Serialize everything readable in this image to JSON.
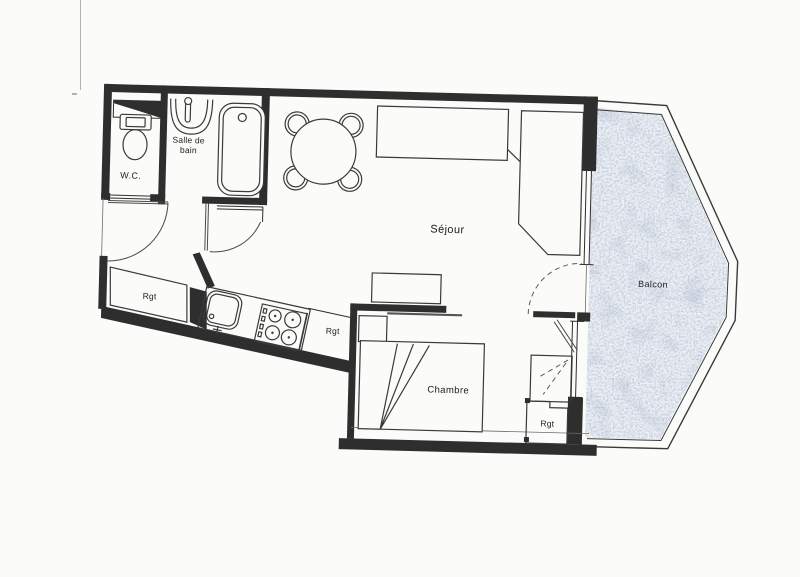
{
  "colors": {
    "ink": "#2e2e2e",
    "paper": "#fbfbf9",
    "label": "#1c1c1c",
    "balcony_base": "#edf0f5",
    "balcony_tint": "#7e8ca2"
  },
  "rooms": {
    "wc": {
      "label": "W.C."
    },
    "bathroom": {
      "label_line1": "Salle de",
      "label_line2": "bain"
    },
    "living_room": {
      "label": "Séjour"
    },
    "bedroom": {
      "label": "Chambre"
    },
    "balcony": {
      "label": "Balcon"
    },
    "storage_kitchen_left": {
      "label": "Rgt"
    },
    "storage_kitchen_right": {
      "label": "Rgt"
    },
    "storage_bedroom": {
      "label": "Rgt"
    }
  }
}
